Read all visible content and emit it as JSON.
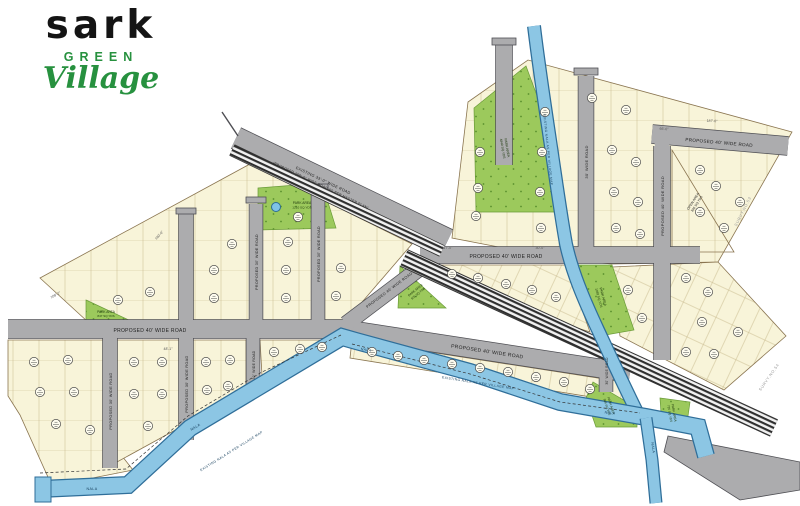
{
  "logo": {
    "brand": "sark",
    "green": "GREEN",
    "village": "Village"
  },
  "map": {
    "roads": [
      {
        "id": "master-plan-road",
        "label": "EXISTING 33'-0\" WIDE ROAD",
        "label2": "(PROPOSED 100'-0\" WIDE ROAD AS PER MASTER PLAN)"
      },
      {
        "id": "left-main-road",
        "label": "PROPOSED 40' WIDE ROAD"
      },
      {
        "id": "center-diagonal-road",
        "label": "PROPOSED 40' WIDE ROAD"
      },
      {
        "id": "connector-road",
        "label": "PROPOSED 40' WIDE ROAD"
      },
      {
        "id": "right-main-road",
        "label": "PROPOSED 40' WIDE ROAD"
      },
      {
        "id": "top-right-road",
        "label": "PROPOSED 40' WIDE ROAD"
      },
      {
        "id": "right-vertical-road",
        "label": "PROPOSED 40' WIDE ROAD"
      },
      {
        "id": "topright-vertical-road",
        "label": "30' WIDE ROAD"
      },
      {
        "id": "left-vertical-road-1",
        "label": "PROPOSED 30' WIDE ROAD"
      },
      {
        "id": "left-vertical-road-2",
        "label": "PROPOSED 30' WIDE ROAD"
      },
      {
        "id": "left-vertical-road-3",
        "label": "30' WIDE ROAD"
      },
      {
        "id": "mid-vertical-road-1",
        "label": "PROPOSED 30' WIDE ROAD"
      },
      {
        "id": "mid-vertical-road-2",
        "label": "PROPOSED 30' WIDE ROAD"
      },
      {
        "id": "se-vertical-road",
        "label": "30' WIDE ROAD"
      }
    ],
    "parks": [
      {
        "name": "PARK AREA",
        "area": "4840 SQ.YDS"
      },
      {
        "name": "PARK AREA",
        "area": "1210 SQ.YDS"
      },
      {
        "name": "PARK AREA",
        "area": "605 SQ.YDS"
      },
      {
        "name": "PARK AREA",
        "area": "847 SQ.YDS"
      },
      {
        "name": "PARK AREA",
        "area": "968 SQ.YDS"
      },
      {
        "name": "PARK AREA",
        "area": "726 SQ.YDS"
      },
      {
        "name": "PARK AREA",
        "area": "1089 SQ.YDS"
      }
    ],
    "open_area": {
      "name": "OPEN AREA",
      "area": "846 SQ.YDS"
    },
    "water": {
      "type": "nala",
      "labels": [
        "NALA",
        "NALA",
        "NALA",
        "NALA",
        "NALA"
      ],
      "long_label": "EXISTING NALA AS PER VILLAGE MAP"
    },
    "survey_labels": [
      "SURVY.NO.53",
      "SURVY.NO.54"
    ],
    "dimensions": [
      "187'-0\"",
      "117'-0\"",
      "108'-2\"",
      "140'-0\"",
      "160'-0\"",
      "48'-1\"",
      "30'-0\"",
      "66'-0\""
    ],
    "colors": {
      "plot": "#F8F4D9",
      "road": "#ACACAE",
      "park": "#9CC95C",
      "water": "#8CC6E4",
      "accent_green": "#27913F"
    }
  }
}
